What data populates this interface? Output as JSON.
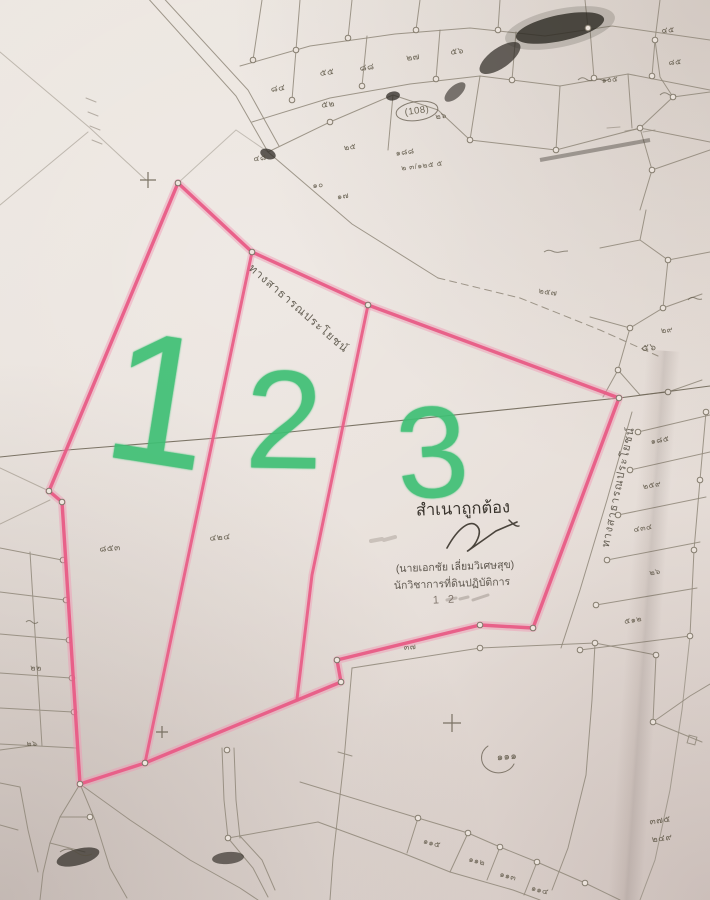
{
  "annotations": {
    "marker_color": "#3fc075",
    "green_plot_numbers": [
      {
        "text": "1",
        "x": 160,
        "y": 401,
        "size": 186,
        "rotate": 9
      },
      {
        "text": "2",
        "x": 284,
        "y": 420,
        "size": 140,
        "rotate": 1
      },
      {
        "text": "3",
        "x": 432,
        "y": 452,
        "size": 130,
        "rotate": -4
      }
    ]
  },
  "certification": {
    "title": "สำเนาถูกต้อง",
    "name": "(นายเอกชัย เลี่ยมวิเศษสุข)",
    "position": "นักวิชาการที่ดินปฏิบัติการ",
    "date_fragment": "1 2"
  },
  "roads": {
    "top_label": "ทางสาธารณประโยชน์",
    "right_label": "ทางสาธารณประโยชน์"
  },
  "colors": {
    "paper": "#e9e1da",
    "highlight_pink": "#e85c86",
    "marker_green": "#3fc075",
    "survey_ink": "#8f8779"
  },
  "parcel_labels": [
    {
      "t": "๘๔",
      "x": 278,
      "y": 88,
      "s": 9,
      "r": -8
    },
    {
      "t": "๕๕",
      "x": 327,
      "y": 72,
      "s": 9,
      "r": -8
    },
    {
      "t": "๘๘",
      "x": 367,
      "y": 67,
      "s": 9,
      "r": -8
    },
    {
      "t": "๒๗",
      "x": 413,
      "y": 57,
      "s": 9,
      "r": -8
    },
    {
      "t": "๕๖",
      "x": 457,
      "y": 51,
      "s": 9,
      "r": -8
    },
    {
      "t": "๕๒",
      "x": 328,
      "y": 104,
      "s": 9,
      "r": -8
    },
    {
      "t": "๔๘",
      "x": 260,
      "y": 158,
      "s": 8,
      "r": -8
    },
    {
      "t": "๒๕",
      "x": 350,
      "y": 147,
      "s": 8,
      "r": -8
    },
    {
      "t": "๑๘๘",
      "x": 405,
      "y": 152,
      "s": 8,
      "r": -8
    },
    {
      "t": "๒ ๓/๑๒๕ ๕",
      "x": 422,
      "y": 166,
      "s": 7.5,
      "r": -7
    },
    {
      "t": "๑๐",
      "x": 318,
      "y": 185,
      "s": 8,
      "r": -8
    },
    {
      "t": "๑๗",
      "x": 343,
      "y": 196,
      "s": 8,
      "r": -8
    },
    {
      "t": "(108)",
      "x": 417,
      "y": 111,
      "s": 9.5,
      "r": -8
    },
    {
      "t": "๒๖",
      "x": 441,
      "y": 116,
      "s": 8,
      "r": -8
    },
    {
      "t": "๔๕",
      "x": 668,
      "y": 30,
      "s": 8,
      "r": -5
    },
    {
      "t": "๘๕",
      "x": 675,
      "y": 62,
      "s": 8,
      "r": -5
    },
    {
      "t": "๑๐๕",
      "x": 610,
      "y": 80,
      "s": 7.5,
      "r": -5
    },
    {
      "t": "๒๕๗",
      "x": 548,
      "y": 292,
      "s": 8,
      "r": 8
    },
    {
      "t": "๕๖",
      "x": 649,
      "y": 348,
      "s": 10,
      "r": -5
    },
    {
      "t": "๒๙",
      "x": 667,
      "y": 330,
      "s": 8,
      "r": -5
    },
    {
      "t": "๑๘๕",
      "x": 660,
      "y": 440,
      "s": 8,
      "r": -10
    },
    {
      "t": "๒๕๙",
      "x": 652,
      "y": 485,
      "s": 8,
      "r": -10
    },
    {
      "t": "๔๓๔",
      "x": 643,
      "y": 528,
      "s": 8,
      "r": -10
    },
    {
      "t": "๒๖",
      "x": 655,
      "y": 572,
      "s": 8,
      "r": -10
    },
    {
      "t": "๕๑๒",
      "x": 633,
      "y": 620,
      "s": 8,
      "r": -10
    },
    {
      "t": "๓๗",
      "x": 410,
      "y": 647,
      "s": 8,
      "r": -5
    },
    {
      "t": "๘๕๓",
      "x": 110,
      "y": 548,
      "s": 9,
      "r": -5
    },
    {
      "t": "๔๒๔",
      "x": 220,
      "y": 537,
      "s": 9,
      "r": -5
    },
    {
      "t": "๑๑๑",
      "x": 507,
      "y": 757,
      "s": 10,
      "r": -5
    },
    {
      "t": "๑๑๕",
      "x": 432,
      "y": 843,
      "s": 8,
      "r": 15
    },
    {
      "t": "๑๑๒",
      "x": 477,
      "y": 861,
      "s": 8,
      "r": 15
    },
    {
      "t": "๑๑๓",
      "x": 508,
      "y": 876,
      "s": 8,
      "r": 15
    },
    {
      "t": "๑๑๔",
      "x": 540,
      "y": 890,
      "s": 8,
      "r": 15
    },
    {
      "t": "๓๗๕",
      "x": 660,
      "y": 820,
      "s": 9,
      "r": -8
    },
    {
      "t": "๒๔๙",
      "x": 662,
      "y": 838,
      "s": 9,
      "r": -8
    },
    {
      "t": "๒๒",
      "x": 36,
      "y": 668,
      "s": 8,
      "r": 0
    },
    {
      "t": "๒๖",
      "x": 32,
      "y": 744,
      "s": 7.5,
      "r": 0
    }
  ]
}
